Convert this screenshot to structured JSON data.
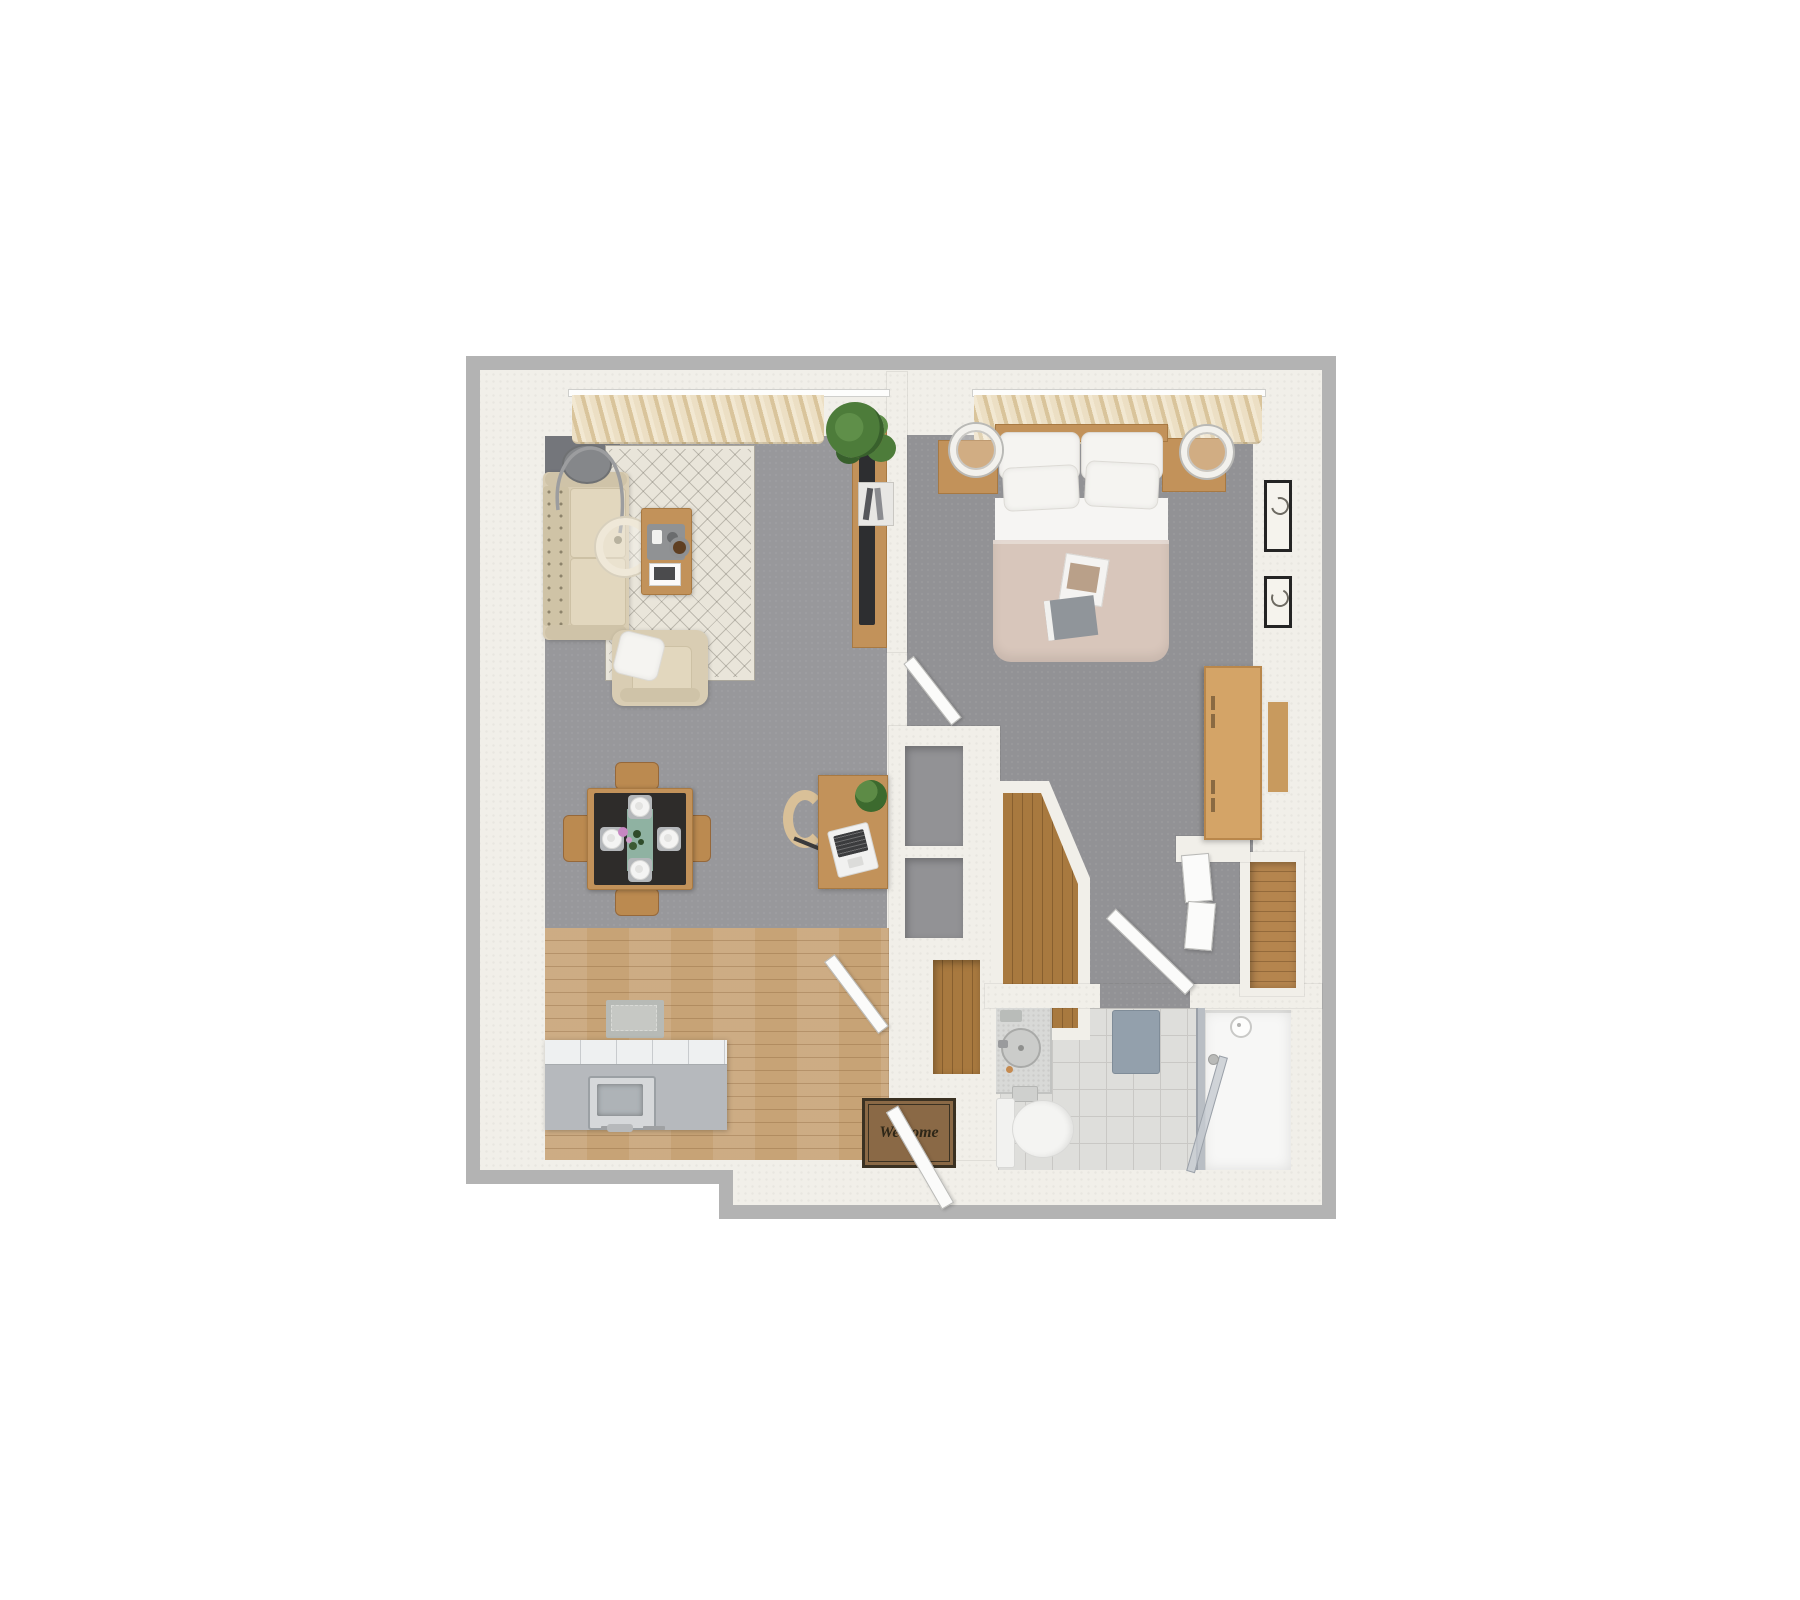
{
  "palette": {
    "background": "#ffffff",
    "wall_trim": "#b3b3b3",
    "wall": "#f1efe9",
    "floor_living": "#98989b",
    "floor_bedroom": "#929295",
    "floor_dark_patch": "#74767b",
    "wood": "#c2925a",
    "wood_dark": "#a87942",
    "wood_floor": "#c7a376",
    "closet_wood": "#a8793f",
    "rug": "#e9e5da",
    "rug_line": "#aaa69b",
    "sofa": "#d9cdb3",
    "sofa_cushion": "#e2d7be",
    "curtain_light": "#ecdfc4",
    "curtain_dark": "#d9c49b",
    "duvet": "#d8c6bb",
    "linen": "#f5f4f1",
    "tile": "#dededb",
    "tile_line": "#c9c8c5",
    "shower_mat": "#93a0ac",
    "island_body": "#b6b9bd",
    "island_top": "#eef0f1",
    "steel": "#c6c9cc",
    "mat_brown": "#8a6946",
    "mat_border": "#3a3122",
    "mat_text_color": "#2e2718",
    "teal_runner": "#8fb2a2",
    "plant_green": "#4d7c3a",
    "tv_dark": "#2d2e30",
    "door": "#fbfbfa",
    "door_line": "#b9b9b6",
    "glass": "#b9bec4"
  },
  "entry_mat": {
    "text": "Welcome"
  }
}
